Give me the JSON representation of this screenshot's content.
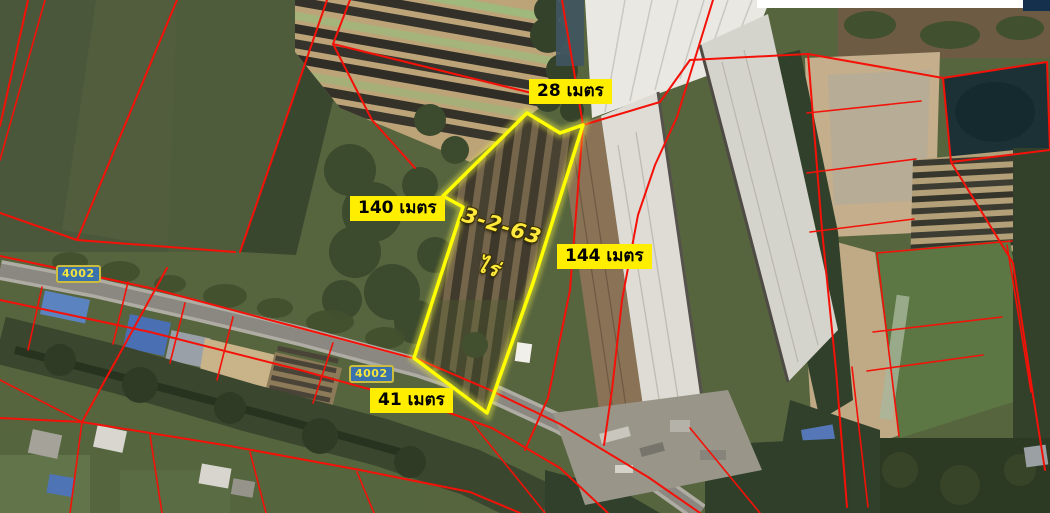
{
  "map": {
    "labels": {
      "top": "28 เมตร",
      "left": "140 เมตร",
      "right": "144 เมตร",
      "bottom": "41 เมตร"
    },
    "area": {
      "line1": "3-2-63",
      "line2": "ไร่"
    },
    "route_badges": [
      "4002",
      "4002"
    ],
    "colors": {
      "label_bg": "#ffee00",
      "label_text": "#000000",
      "plot_outline": "#ffff00",
      "parcel_line": "#f41108",
      "badge_bg": "#3a72ad",
      "badge_border": "#cdbd3e",
      "badge_text": "#f2e43c",
      "area_text": "#ffe93c"
    }
  }
}
